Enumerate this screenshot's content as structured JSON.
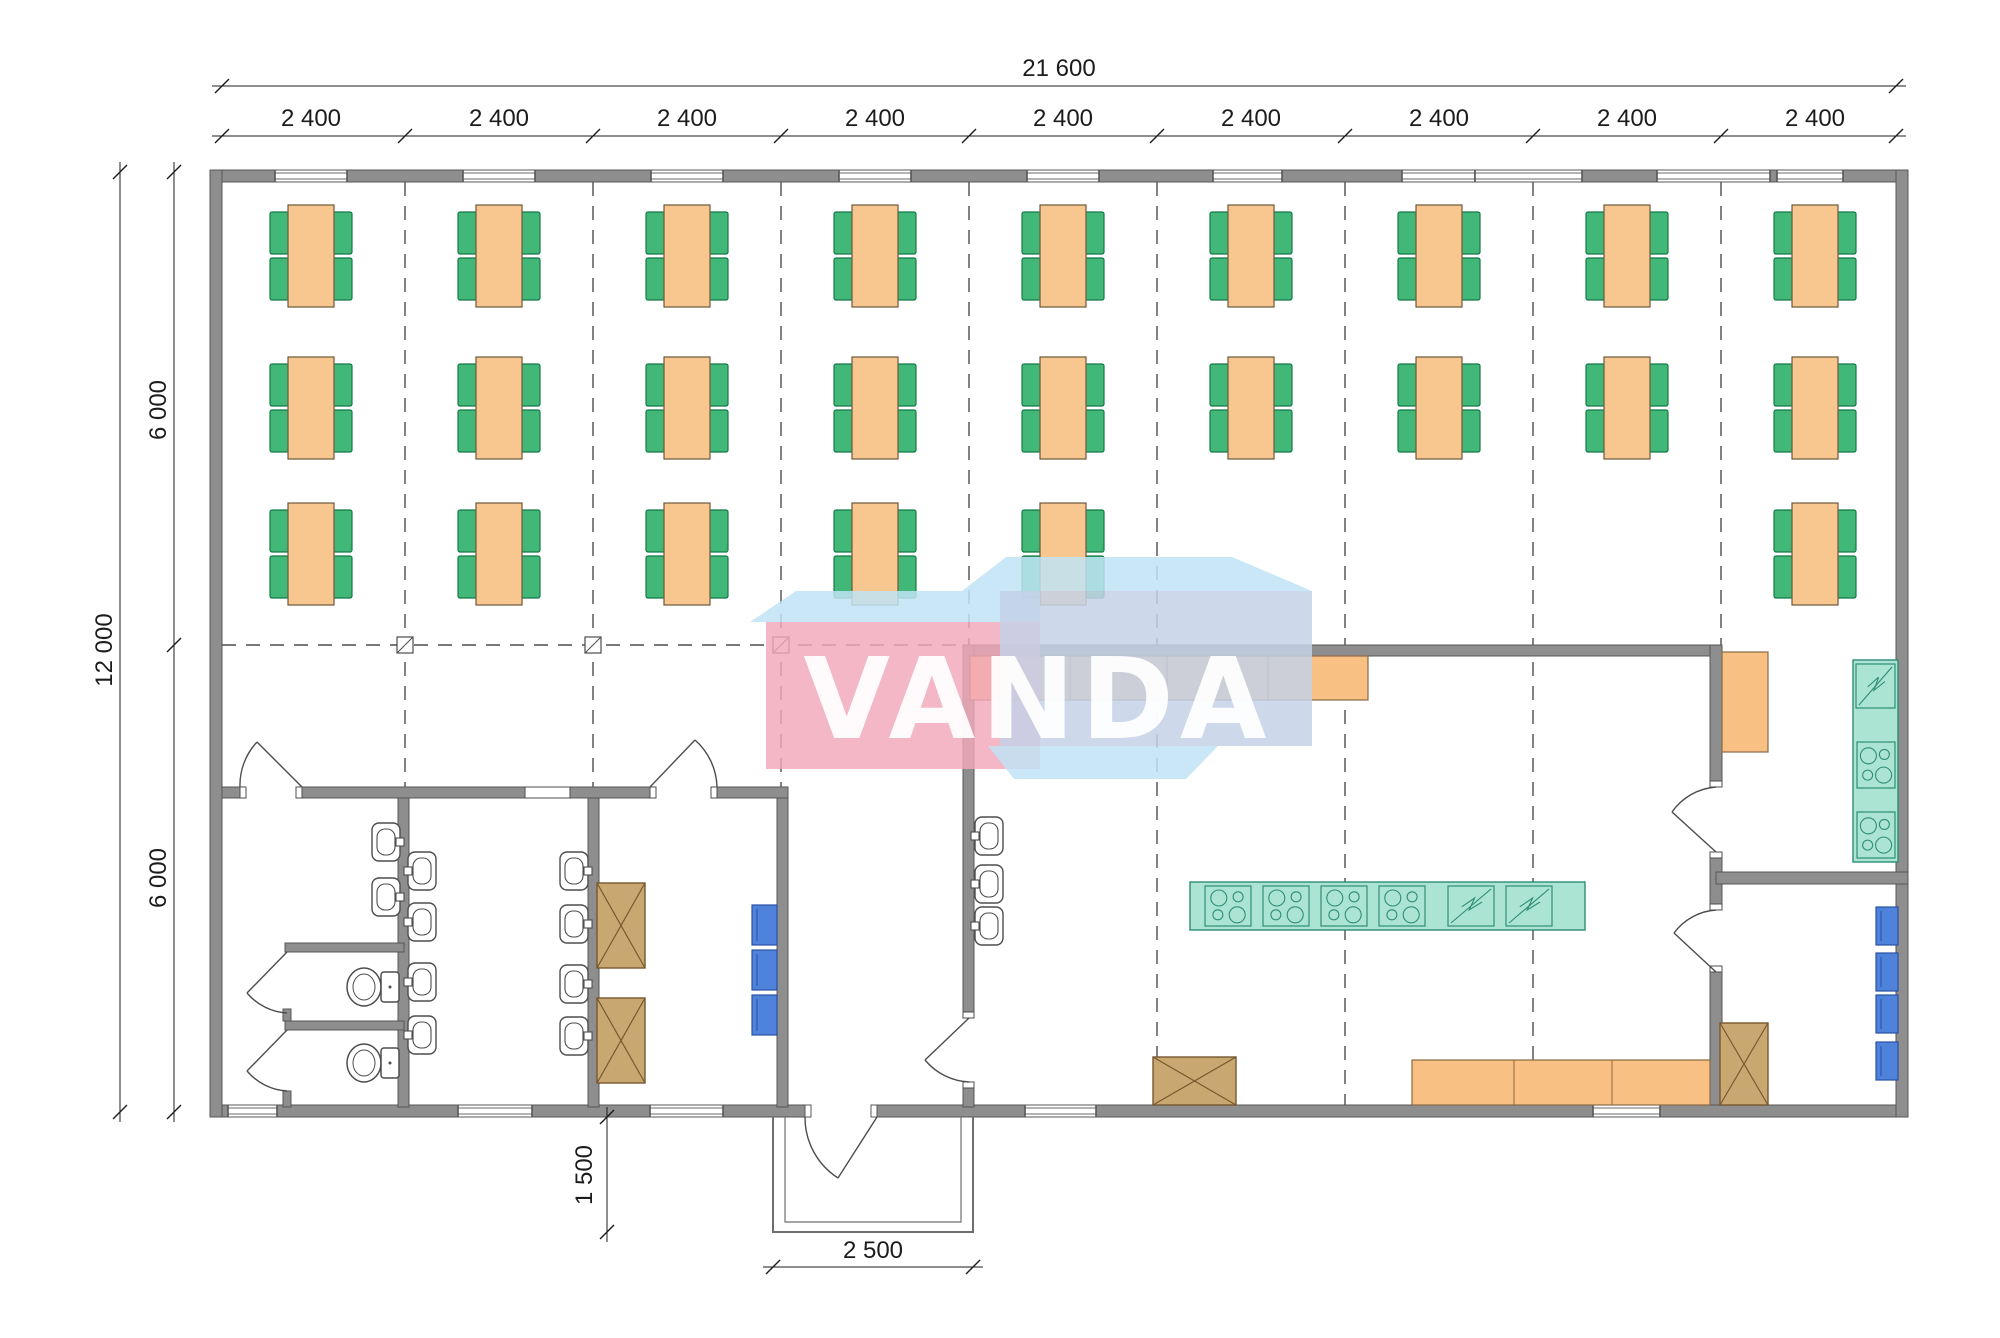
{
  "drawing": {
    "type": "floor-plan",
    "watermark_text": "VANDA"
  },
  "dimensions": {
    "overall_width": "21 600",
    "bay_labels": [
      "2 400",
      "2 400",
      "2 400",
      "2 400",
      "2 400",
      "2 400",
      "2 400",
      "2 400",
      "2 400"
    ],
    "overall_height": "12 000",
    "half_height_top": "6 000",
    "half_height_bottom": "6 000",
    "porch_depth": "1 500",
    "porch_width": "2 500"
  },
  "colors": {
    "wall": "#8E8E8E",
    "wall_edge": "#575757",
    "table": "#F7C78F",
    "table_edge": "#6D573A",
    "chair": "#41B878",
    "chair_edge": "#157A47",
    "counter": "#F9C083",
    "counter_edge": "#8A6A45",
    "teal": "#ABE4D3",
    "teal_edge": "#2E8D76",
    "cabinet": "#C9A770",
    "cabinet_edge": "#77582F",
    "shelf": "#4E82DB",
    "shelf_edge": "#2B50A4",
    "fixture_stroke": "#4D4D4D",
    "grid_line": "#4D4D4D",
    "dim_line": "#1C1C1C",
    "watermark_pink": "#F2A7B8",
    "watermark_blue": "#C4D1E6",
    "watermark_sky": "#BFE3F5"
  }
}
